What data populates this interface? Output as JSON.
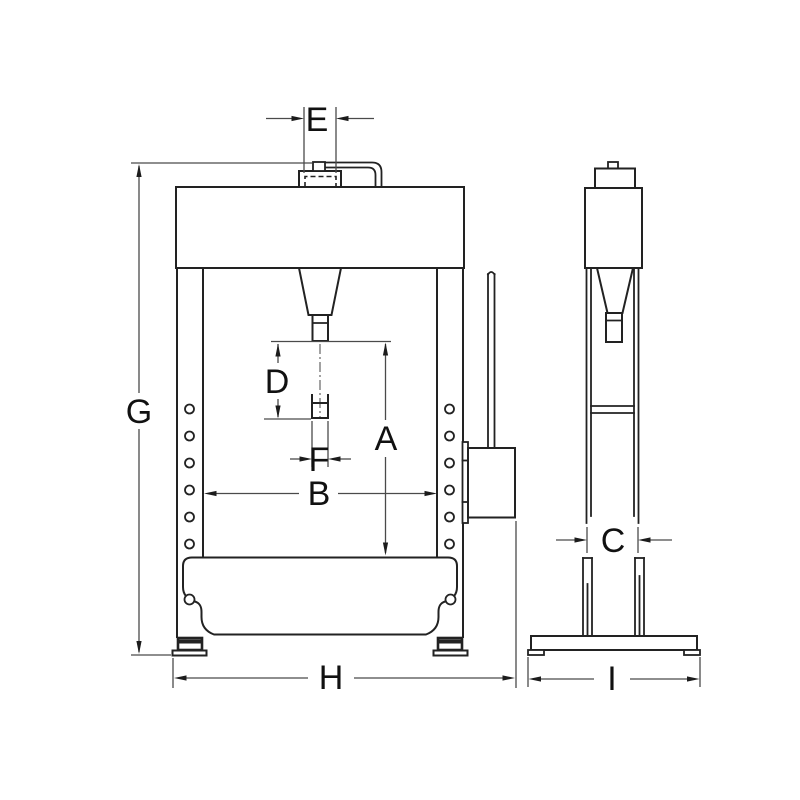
{
  "drawing": {
    "dimension_labels": {
      "A": "A",
      "B": "B",
      "C": "C",
      "D": "D",
      "E": "E",
      "F": "F",
      "G": "G",
      "H": "H",
      "I": "I"
    },
    "colors": {
      "line": "#222222",
      "dimension_line": "#4a4a4a",
      "label": "#111111",
      "background": "#ffffff"
    }
  }
}
